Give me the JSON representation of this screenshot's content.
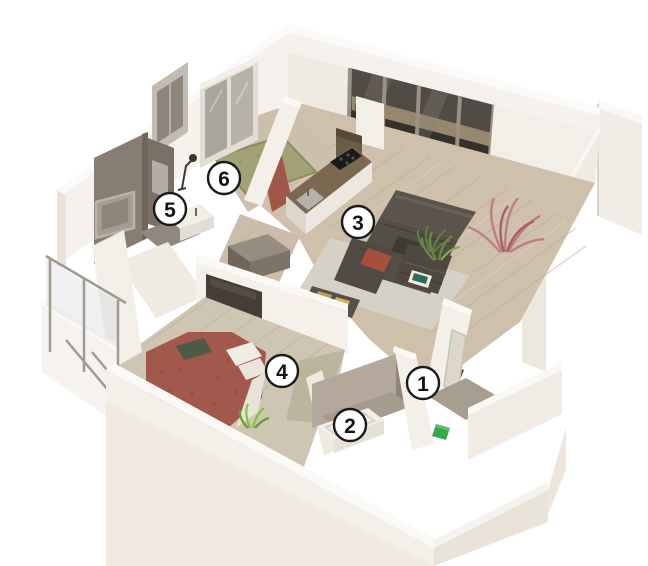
{
  "scene": {
    "kind": "3d-apartment-floor-plan-render",
    "background": "#ffffff"
  },
  "room_markers": [
    {
      "label": "1"
    },
    {
      "label": "2"
    },
    {
      "label": "3"
    },
    {
      "label": "4"
    },
    {
      "label": "5"
    },
    {
      "label": "6"
    }
  ],
  "palette": {
    "wall_white": "#f3efe9",
    "wall_top": "#fbf9f6",
    "wall_shadow": "#e7e0d6",
    "wood_floor": "#cfc0ab",
    "living_rug": "#d6d1c6",
    "bed_terracotta": "#a2584a",
    "sofa_dark": "#57504a",
    "kitchen_counter": "#7a6950",
    "bathroom_wall_dark": "#877d72",
    "bathroom_wall_light": "#b3a89a",
    "room6_rug_green": "#a3a176",
    "plant_green": "#6b8a44",
    "plant_pink": "#bd7e86",
    "entry_box_green": "#3aa64b",
    "badge_fill": "#ffffff",
    "badge_border": "#1a1a1a"
  }
}
